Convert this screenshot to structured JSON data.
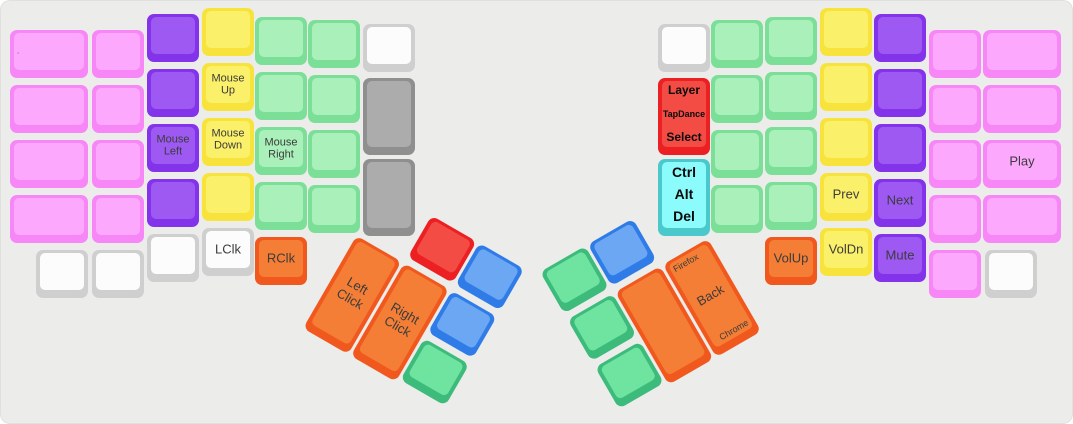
{
  "page": {
    "background": "#ECECEB"
  },
  "palette": {
    "pink": {
      "side": "#F786F7",
      "top": "#FCA8FC"
    },
    "purple": {
      "side": "#8333E9",
      "top": "#9D59F2"
    },
    "yellow": {
      "side": "#F8E33C",
      "top": "#FBF06A"
    },
    "green": {
      "side": "#7BDF98",
      "top": "#A9F0BB"
    },
    "emerald": {
      "side": "#3CBB7B",
      "top": "#6FE3A0"
    },
    "white": {
      "side": "#CFCFCF",
      "top": "#FCFCFC"
    },
    "gray": {
      "side": "#8F8F8F",
      "top": "#ACACAC"
    },
    "orange": {
      "side": "#F1581D",
      "top": "#F47E35"
    },
    "red": {
      "side": "#EC2022",
      "top": "#F24C45"
    },
    "blue": {
      "side": "#2F7CE8",
      "top": "#6BA7F3"
    },
    "cyan": {
      "side": "#49C9CB",
      "top": "#8BFBFB"
    }
  },
  "keyboard": {
    "unit": {
      "w": 52,
      "h": 48
    },
    "keys": [
      {
        "name": "key-period",
        "x": 10,
        "y": 30,
        "w": 78,
        "color": "pink",
        "labels": [
          {
            "t": ".",
            "pos": "lc",
            "size": 8
          }
        ]
      },
      {
        "x": 10,
        "y": 85,
        "w": 78,
        "color": "pink"
      },
      {
        "x": 10,
        "y": 140,
        "w": 78,
        "color": "pink"
      },
      {
        "x": 10,
        "y": 195,
        "w": 78,
        "color": "pink"
      },
      {
        "x": 92,
        "y": 30,
        "color": "pink"
      },
      {
        "x": 92,
        "y": 85,
        "color": "pink"
      },
      {
        "x": 92,
        "y": 140,
        "color": "pink"
      },
      {
        "x": 92,
        "y": 195,
        "color": "pink"
      },
      {
        "x": 147,
        "y": 14,
        "color": "purple"
      },
      {
        "x": 147,
        "y": 69,
        "color": "purple"
      },
      {
        "name": "key-mouse-left",
        "x": 147,
        "y": 124,
        "color": "purple",
        "labels": [
          {
            "t": "Mouse Left",
            "pos": "c",
            "size": 11
          }
        ]
      },
      {
        "x": 147,
        "y": 179,
        "color": "purple"
      },
      {
        "x": 202,
        "y": 8,
        "color": "yellow"
      },
      {
        "name": "key-mouse-up",
        "x": 202,
        "y": 63,
        "color": "yellow",
        "labels": [
          {
            "t": "Mouse Up",
            "pos": "c",
            "size": 11
          }
        ]
      },
      {
        "name": "key-mouse-down",
        "x": 202,
        "y": 118,
        "color": "yellow",
        "labels": [
          {
            "t": "Mouse Down",
            "pos": "c",
            "size": 11
          }
        ]
      },
      {
        "x": 202,
        "y": 173,
        "color": "yellow"
      },
      {
        "x": 255,
        "y": 17,
        "color": "green"
      },
      {
        "x": 255,
        "y": 72,
        "color": "green"
      },
      {
        "name": "key-mouse-right",
        "x": 255,
        "y": 127,
        "color": "green",
        "labels": [
          {
            "t": "Mouse Right",
            "pos": "c",
            "size": 11
          }
        ]
      },
      {
        "x": 255,
        "y": 182,
        "color": "green"
      },
      {
        "x": 308,
        "y": 20,
        "color": "green"
      },
      {
        "x": 308,
        "y": 75,
        "color": "green"
      },
      {
        "x": 308,
        "y": 130,
        "color": "green"
      },
      {
        "x": 308,
        "y": 185,
        "color": "green"
      },
      {
        "x": 363,
        "y": 24,
        "color": "white"
      },
      {
        "x": 363,
        "y": 78,
        "h": 77,
        "color": "gray"
      },
      {
        "x": 363,
        "y": 159,
        "h": 77,
        "color": "gray"
      },
      {
        "x": 36,
        "y": 250,
        "color": "white"
      },
      {
        "x": 92,
        "y": 250,
        "color": "white"
      },
      {
        "x": 147,
        "y": 234,
        "color": "white"
      },
      {
        "name": "key-lclk",
        "x": 202,
        "y": 228,
        "color": "white",
        "labels": [
          {
            "t": "LClk",
            "pos": "c",
            "size": 13
          }
        ]
      },
      {
        "name": "key-rclk",
        "x": 255,
        "y": 237,
        "color": "orange",
        "labels": [
          {
            "t": "RClk",
            "pos": "c",
            "size": 13
          }
        ]
      },
      {
        "x": 658,
        "y": 24,
        "color": "white"
      },
      {
        "name": "key-layer-tapdance-select",
        "x": 658,
        "y": 78,
        "h": 77,
        "color": "red",
        "labels": [
          {
            "t": "Layer",
            "pos": "top",
            "size": 12,
            "bold": true
          },
          {
            "t": "TapDance",
            "pos": "mid",
            "size": 9,
            "bold": true
          },
          {
            "t": "Select",
            "pos": "bottom",
            "size": 12,
            "bold": true
          }
        ]
      },
      {
        "name": "key-ctrl-alt-del",
        "x": 658,
        "y": 159,
        "h": 77,
        "color": "cyan",
        "labels": [
          {
            "t": "Ctrl",
            "pos": "top",
            "size": 14,
            "bold": true
          },
          {
            "t": "Alt",
            "pos": "mid",
            "size": 14,
            "bold": true
          },
          {
            "t": "Del",
            "pos": "bottom",
            "size": 14,
            "bold": true
          }
        ]
      },
      {
        "x": 711,
        "y": 20,
        "color": "green"
      },
      {
        "x": 711,
        "y": 75,
        "color": "green"
      },
      {
        "x": 711,
        "y": 130,
        "color": "green"
      },
      {
        "x": 711,
        "y": 185,
        "color": "green"
      },
      {
        "x": 765,
        "y": 17,
        "color": "green"
      },
      {
        "x": 765,
        "y": 72,
        "color": "green"
      },
      {
        "x": 765,
        "y": 127,
        "color": "green"
      },
      {
        "x": 765,
        "y": 182,
        "color": "green"
      },
      {
        "x": 820,
        "y": 8,
        "color": "yellow"
      },
      {
        "x": 820,
        "y": 63,
        "color": "yellow"
      },
      {
        "x": 820,
        "y": 118,
        "color": "yellow"
      },
      {
        "name": "key-prev",
        "x": 820,
        "y": 173,
        "color": "yellow",
        "labels": [
          {
            "t": "Prev",
            "pos": "c",
            "size": 13
          }
        ]
      },
      {
        "x": 874,
        "y": 14,
        "color": "purple"
      },
      {
        "x": 874,
        "y": 69,
        "color": "purple"
      },
      {
        "x": 874,
        "y": 124,
        "color": "purple"
      },
      {
        "name": "key-next",
        "x": 874,
        "y": 179,
        "color": "purple",
        "labels": [
          {
            "t": "Next",
            "pos": "c",
            "size": 13
          }
        ]
      },
      {
        "x": 929,
        "y": 30,
        "color": "pink"
      },
      {
        "x": 929,
        "y": 85,
        "color": "pink"
      },
      {
        "x": 929,
        "y": 140,
        "color": "pink"
      },
      {
        "x": 929,
        "y": 195,
        "color": "pink"
      },
      {
        "x": 983,
        "y": 30,
        "w": 78,
        "color": "pink"
      },
      {
        "x": 983,
        "y": 85,
        "w": 78,
        "color": "pink"
      },
      {
        "name": "key-play",
        "x": 983,
        "y": 140,
        "w": 78,
        "color": "pink",
        "labels": [
          {
            "t": "Play",
            "pos": "c",
            "size": 13
          }
        ]
      },
      {
        "x": 983,
        "y": 195,
        "w": 78,
        "color": "pink"
      },
      {
        "name": "key-volup",
        "x": 765,
        "y": 237,
        "color": "orange",
        "labels": [
          {
            "t": "VolUp",
            "pos": "c",
            "size": 13
          }
        ]
      },
      {
        "name": "key-voldn",
        "x": 820,
        "y": 228,
        "color": "yellow",
        "labels": [
          {
            "t": "VolDn",
            "pos": "c",
            "size": 13
          }
        ]
      },
      {
        "name": "key-mute",
        "x": 874,
        "y": 234,
        "color": "purple",
        "labels": [
          {
            "t": "Mute",
            "pos": "c",
            "size": 13
          }
        ]
      },
      {
        "x": 929,
        "y": 250,
        "color": "pink"
      },
      {
        "x": 985,
        "y": 250,
        "color": "white"
      }
    ],
    "clusters": [
      {
        "name": "left-thumb-cluster",
        "x": 384,
        "y": 188,
        "angle": 30,
        "keys": [
          {
            "x": 55,
            "y": 0,
            "color": "red"
          },
          {
            "x": 110,
            "y": 0,
            "color": "blue"
          },
          {
            "name": "key-left-click",
            "x": 0,
            "y": 55,
            "h": 107,
            "color": "orange",
            "labels": [
              {
                "t": "Left Click",
                "pos": "c",
                "size": 13
              }
            ]
          },
          {
            "name": "key-right-click",
            "x": 55,
            "y": 55,
            "h": 107,
            "color": "orange",
            "labels": [
              {
                "t": "Right Click",
                "pos": "c",
                "size": 13
              }
            ]
          },
          {
            "x": 110,
            "y": 55,
            "color": "blue"
          },
          {
            "x": 110,
            "y": 110,
            "color": "emerald"
          }
        ]
      },
      {
        "name": "right-thumb-cluster",
        "x": 540,
        "y": 272,
        "angle": -30,
        "keys": [
          {
            "x": 0,
            "y": 0,
            "color": "emerald"
          },
          {
            "x": 55,
            "y": 0,
            "color": "blue"
          },
          {
            "x": 0,
            "y": 55,
            "color": "emerald"
          },
          {
            "x": 0,
            "y": 110,
            "color": "emerald"
          },
          {
            "x": 55,
            "y": 55,
            "h": 107,
            "color": "orange"
          },
          {
            "name": "key-back-browser",
            "x": 110,
            "y": 55,
            "h": 107,
            "color": "orange",
            "labels": [
              {
                "t": "Firefox",
                "pos": "tl",
                "size": 9
              },
              {
                "t": "Back",
                "pos": "c",
                "size": 13
              },
              {
                "t": "Chrome",
                "pos": "br",
                "size": 9
              }
            ]
          }
        ]
      }
    ]
  }
}
